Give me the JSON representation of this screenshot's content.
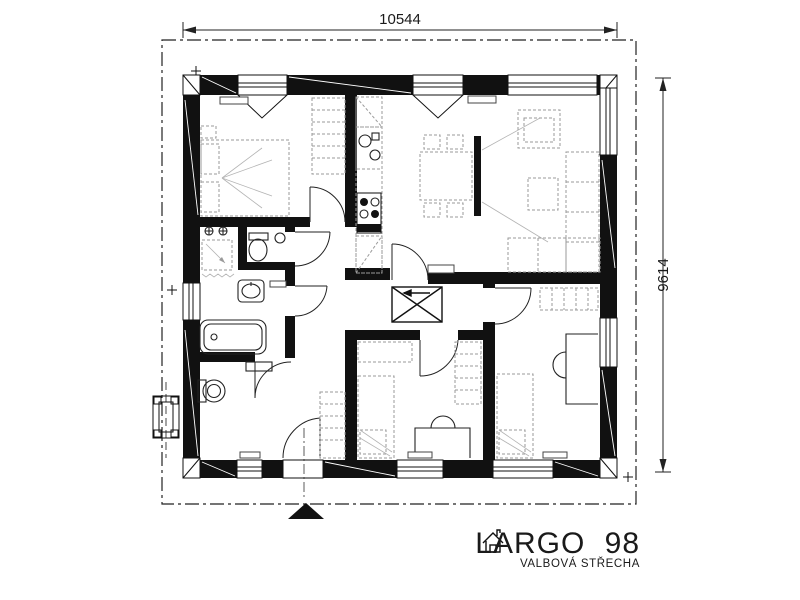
{
  "drawing": {
    "dimension_top": "10544",
    "dimension_right": "9614",
    "title": "LARGO 98",
    "subtitle": "VALBOVÁ STŘECHA"
  },
  "colors": {
    "wall": "#111111",
    "background": "#ffffff",
    "furniture": "#9a9a9a"
  }
}
